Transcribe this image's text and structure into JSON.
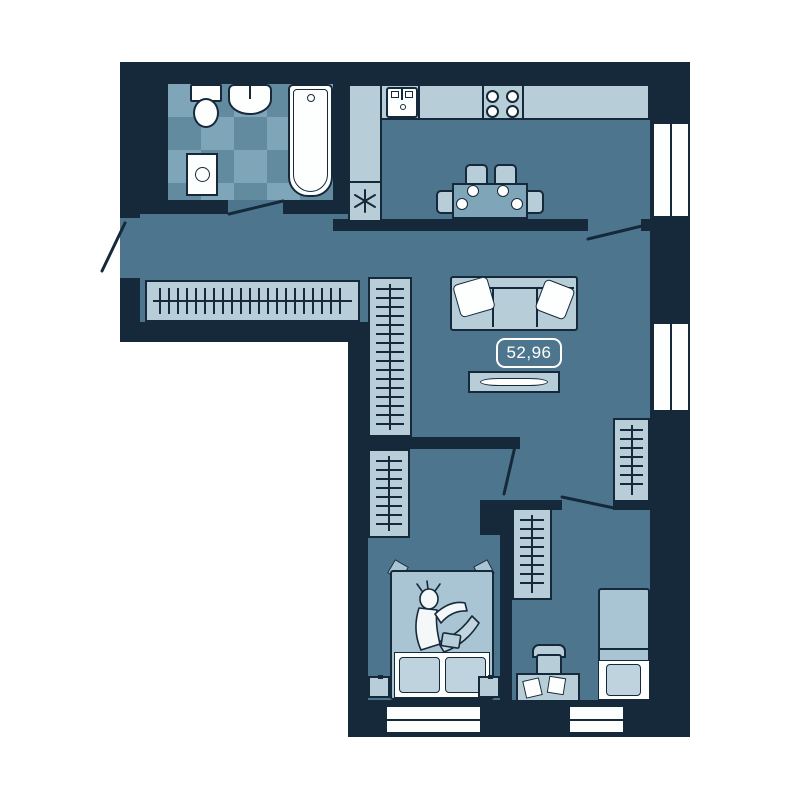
{
  "floor_plan": {
    "area_label": "52,96",
    "colors": {
      "background": "#ffffff",
      "wall": "#16293a",
      "floor": "#4d758d",
      "furniture-light": "#b7ced9",
      "tile-dark": "#628ba0",
      "tile-light": "#7ea6b8",
      "table": "#7fa6b8",
      "blanket": "#a9c4d2",
      "pillow-light": "#bed3de",
      "fixture-white": "#fdfefe"
    },
    "rooms": [
      {
        "name": "bathroom",
        "furniture": [
          "toilet",
          "wash-basin",
          "bathtub",
          "washing-machine",
          "checker-tile-floor"
        ]
      },
      {
        "name": "kitchen-dining",
        "furniture": [
          "kitchen-counter",
          "kitchen-sink",
          "stove-4-burners",
          "refrigerator-star-symbol",
          "dining-table",
          "four-chairs",
          "four-plates"
        ]
      },
      {
        "name": "hallway",
        "furniture": [
          "coat-closet-with-hangers"
        ]
      },
      {
        "name": "living-room",
        "furniture": [
          "sofa",
          "two-pillows",
          "tv-console",
          "wardrobe-with-hangers",
          "corner-wardrobe-with-hangers"
        ]
      },
      {
        "name": "bedroom-left",
        "furniture": [
          "wardrobe-with-hangers",
          "double-bed",
          "person-on-bed",
          "two-nightstands"
        ]
      },
      {
        "name": "bedroom-right",
        "furniture": [
          "wardrobe-with-hangers",
          "desk-with-papers",
          "chair",
          "single-bed"
        ]
      }
    ],
    "windows_count": 4,
    "doors_count": 5
  }
}
